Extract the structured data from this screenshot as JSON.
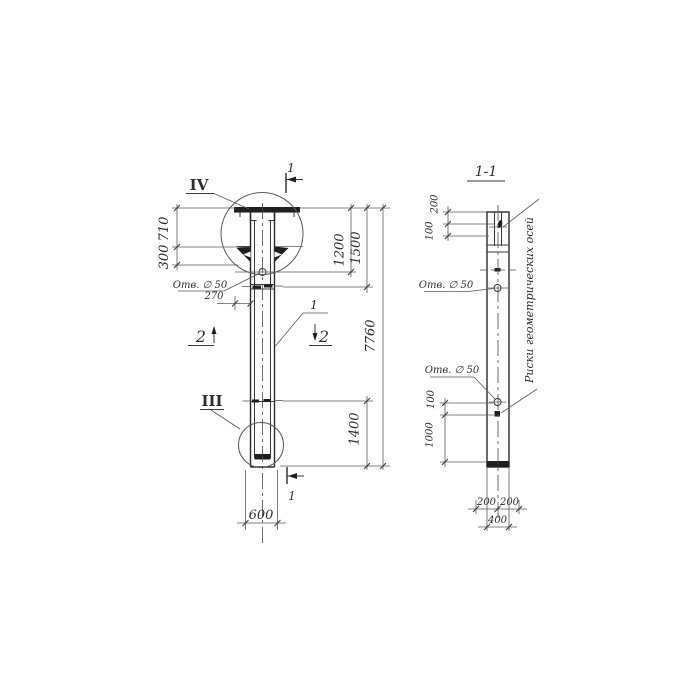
{
  "drawing": {
    "left_view": {
      "detail_top_label": "IV",
      "detail_bottom_label": "III",
      "section_top_label": "1",
      "section_bottom_label": "1",
      "section_left_label": "2",
      "section_right_label": "2",
      "position_label": "1",
      "hole_label": "Отв. ∅ 50",
      "dim_710": "710",
      "dim_300": "300",
      "dim_270": "270",
      "dim_1200": "1200",
      "dim_1500": "1500",
      "dim_7760": "7760",
      "dim_1400": "1400",
      "dim_600": "600"
    },
    "section_view": {
      "title": "1-1",
      "hole_label_upper": "Отв. ∅ 50",
      "hole_label_lower": "Отв. ∅ 50",
      "axes_note": "Риски геометрических осей",
      "dim_200_top": "200",
      "dim_100_top": "100",
      "dim_100_bottom": "100",
      "dim_1000": "1000",
      "dim_200_left": "200",
      "dim_200_right": "200",
      "dim_400": "400"
    }
  }
}
